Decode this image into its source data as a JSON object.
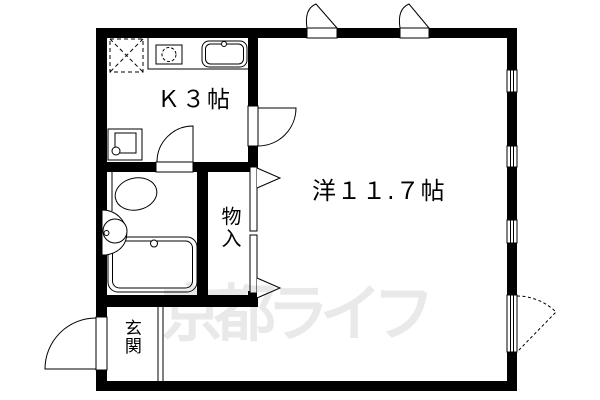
{
  "plan": {
    "background": "#ffffff",
    "wall_color": "#000000",
    "rooms": {
      "kitchen": {
        "label": "Ｋ３帖"
      },
      "western_room": {
        "label": "洋１１.７帖"
      },
      "storage": {
        "label": "物入"
      },
      "entrance": {
        "label": "玄関"
      }
    },
    "fixtures": [
      "refrigerator-space",
      "gas-stove",
      "kitchen-sink",
      "washing-machine-pan",
      "toilet",
      "wash-basin",
      "bathtub"
    ],
    "openings": [
      "entrance-door",
      "bathroom-door",
      "kitchen-room-door",
      "closet-double-door",
      "awning-window-top-1",
      "awning-window-top-2",
      "window-right-1",
      "window-right-2",
      "window-right-3",
      "casement-window-right"
    ],
    "watermark": {
      "text": "京都ライフ",
      "color": "#e9e9e9"
    }
  }
}
